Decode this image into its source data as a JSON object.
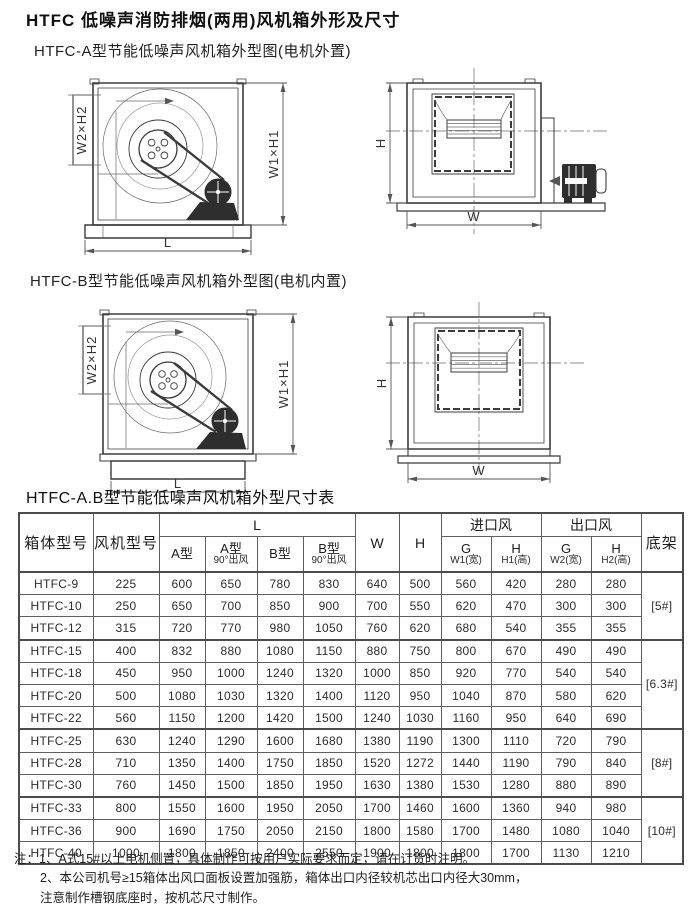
{
  "page": {
    "title": "HTFC 低噪声消防排烟(两用)风机箱外形及尺寸"
  },
  "sections": {
    "a": {
      "heading": "HTFC-A型节能低噪声风机箱外型图(电机外置)"
    },
    "b": {
      "heading": "HTFC-B型节能低噪声风机箱外型图(电机内置)"
    }
  },
  "drawings": {
    "a_side": {
      "left_label": "W2×H2",
      "right_label": "W1×H1",
      "bottom_label": "L"
    },
    "a_front": {
      "left_label": "H",
      "bottom_label": "W"
    },
    "b_side": {
      "left_label": "W2×H2",
      "right_label": "W1×H1",
      "bottom_label": "L"
    },
    "b_front": {
      "left_label": "H",
      "bottom_label": "W"
    }
  },
  "table": {
    "title": "HTFC-A.B型节能低噪声风机箱外型尺寸表",
    "headers": {
      "box_model": "箱体型号",
      "fan_model": "风机型号",
      "l_group": "L",
      "l_cols": [
        {
          "main": "A型",
          "sub": ""
        },
        {
          "main": "A型",
          "sub": "90°出风"
        },
        {
          "main": "B型",
          "sub": ""
        },
        {
          "main": "B型",
          "sub": "90°出风"
        }
      ],
      "w": "W",
      "h": "H",
      "inlet_group": "进口风",
      "inlet_cols": [
        {
          "main": "G",
          "sub": "W1(宽)"
        },
        {
          "main": "H",
          "sub": "H1(高)"
        }
      ],
      "outlet_group": "出口风",
      "outlet_cols": [
        {
          "main": "G",
          "sub": "W2(宽)"
        },
        {
          "main": "H",
          "sub": "H2(高)"
        }
      ],
      "base": "底架"
    },
    "rows": [
      [
        "HTFC-9",
        "225",
        "600",
        "650",
        "780",
        "830",
        "640",
        "500",
        "560",
        "420",
        "280",
        "280"
      ],
      [
        "HTFC-10",
        "250",
        "650",
        "700",
        "850",
        "900",
        "700",
        "550",
        "620",
        "470",
        "300",
        "300"
      ],
      [
        "HTFC-12",
        "315",
        "720",
        "770",
        "980",
        "1050",
        "760",
        "620",
        "680",
        "540",
        "355",
        "355"
      ],
      [
        "HTFC-15",
        "400",
        "832",
        "880",
        "1080",
        "1150",
        "880",
        "750",
        "800",
        "670",
        "490",
        "490"
      ],
      [
        "HTFC-18",
        "450",
        "950",
        "1000",
        "1240",
        "1320",
        "1000",
        "850",
        "920",
        "770",
        "540",
        "540"
      ],
      [
        "HTFC-20",
        "500",
        "1080",
        "1030",
        "1320",
        "1400",
        "1120",
        "950",
        "1040",
        "870",
        "580",
        "620"
      ],
      [
        "HTFC-22",
        "560",
        "1150",
        "1200",
        "1420",
        "1500",
        "1240",
        "1030",
        "1160",
        "950",
        "640",
        "690"
      ],
      [
        "HTFC-25",
        "630",
        "1240",
        "1290",
        "1600",
        "1680",
        "1380",
        "1190",
        "1300",
        "1110",
        "720",
        "790"
      ],
      [
        "HTFC-28",
        "710",
        "1350",
        "1400",
        "1750",
        "1850",
        "1520",
        "1272",
        "1440",
        "1190",
        "790",
        "840"
      ],
      [
        "HTFC-30",
        "760",
        "1450",
        "1500",
        "1850",
        "1950",
        "1630",
        "1380",
        "1530",
        "1280",
        "880",
        "890"
      ],
      [
        "HTFC-33",
        "800",
        "1550",
        "1600",
        "1950",
        "2050",
        "1700",
        "1460",
        "1600",
        "1360",
        "940",
        "980"
      ],
      [
        "HTFC-36",
        "900",
        "1690",
        "1750",
        "2050",
        "2150",
        "1800",
        "1580",
        "1700",
        "1480",
        "1080",
        "1040"
      ],
      [
        "HTFC-40",
        "1000",
        "1800",
        "1850",
        "2400",
        "2550",
        "1900",
        "1800",
        "1800",
        "1700",
        "1130",
        "1210"
      ]
    ],
    "base_groups": [
      {
        "label": "[5#]",
        "span": 3
      },
      {
        "label": "[6.3#]",
        "span": 4
      },
      {
        "label": "[8#]",
        "span": 3
      },
      {
        "label": "[10#]",
        "span": 3
      }
    ]
  },
  "notes": {
    "prefix": "注：",
    "lines": [
      "1、A式15#以上电机侧置，具体制作可按用户实际要求而定，请在订货时注明。",
      "2、本公司机号≥15箱体出风口面板设置加强筋，箱体出口内径较机芯出口内径大30mm，",
      "注意制作槽钢底座时，按机芯尺寸制作。"
    ]
  }
}
